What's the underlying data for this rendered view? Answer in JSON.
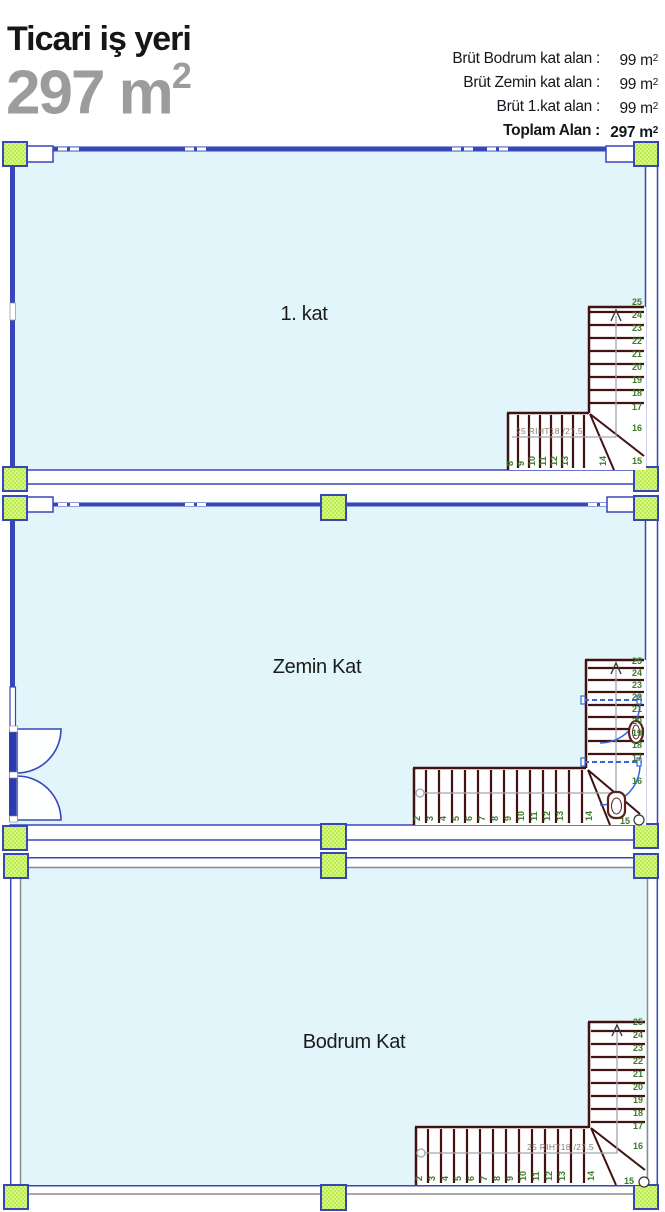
{
  "header": {
    "title": "Ticari iş yeri",
    "area_value": "297 m",
    "area_sup": "2",
    "info_rows": [
      {
        "label": "Brüt Bodrum kat alan :",
        "value": "99 m",
        "sup": "2"
      },
      {
        "label": "Brüt Zemin kat alan :",
        "value": "99 m",
        "sup": "2"
      },
      {
        "label": "Brüt 1.kat alan :",
        "value": "99 m",
        "sup": "2"
      },
      {
        "label": "Toplam Alan :",
        "value": "297 m",
        "sup": "2"
      }
    ]
  },
  "plans": {
    "kat1": {
      "label": "1. kat",
      "stairs": {
        "right_numbers": [
          "25",
          "24",
          "23",
          "22",
          "21",
          "20",
          "19",
          "18",
          "17",
          "16",
          "15"
        ],
        "bottom_numbers": [
          "8",
          "9",
          "10",
          "11",
          "12",
          "13"
        ],
        "winder_number": "14",
        "riser_label": "25 RIHT18 /27.5"
      }
    },
    "zemin": {
      "label": "Zemin Kat",
      "stairs": {
        "right_numbers": [
          "25",
          "24",
          "23",
          "22",
          "21",
          "20",
          "19",
          "18",
          "17",
          "16"
        ],
        "bottom_numbers": [
          "2",
          "3",
          "4",
          "5",
          "6",
          "7",
          "8",
          "9",
          "10",
          "11",
          "12",
          "13"
        ],
        "winder_number": "14",
        "end_number": "15"
      }
    },
    "bodrum": {
      "label": "Bodrum Kat",
      "stairs": {
        "right_numbers": [
          "25",
          "24",
          "23",
          "22",
          "21",
          "20",
          "19",
          "18",
          "17",
          "16"
        ],
        "bottom_numbers": [
          "2",
          "3",
          "4",
          "5",
          "6",
          "7",
          "8",
          "9",
          "10",
          "11",
          "12",
          "13"
        ],
        "winder_number": "14",
        "end_number": "15",
        "riser_label": "25 RIHT18 /27.5"
      }
    }
  },
  "colors": {
    "wall_blue": "#3847B8",
    "interior_fill": "#E2F5FB",
    "column_green": "#CCF266",
    "stair_brown": "#421111",
    "step_number_green": "#3B7A2A",
    "basement_wall_gray": "#8C8C8C",
    "title_gray": "#9C9C9C",
    "door_blue": "#3565D8"
  }
}
